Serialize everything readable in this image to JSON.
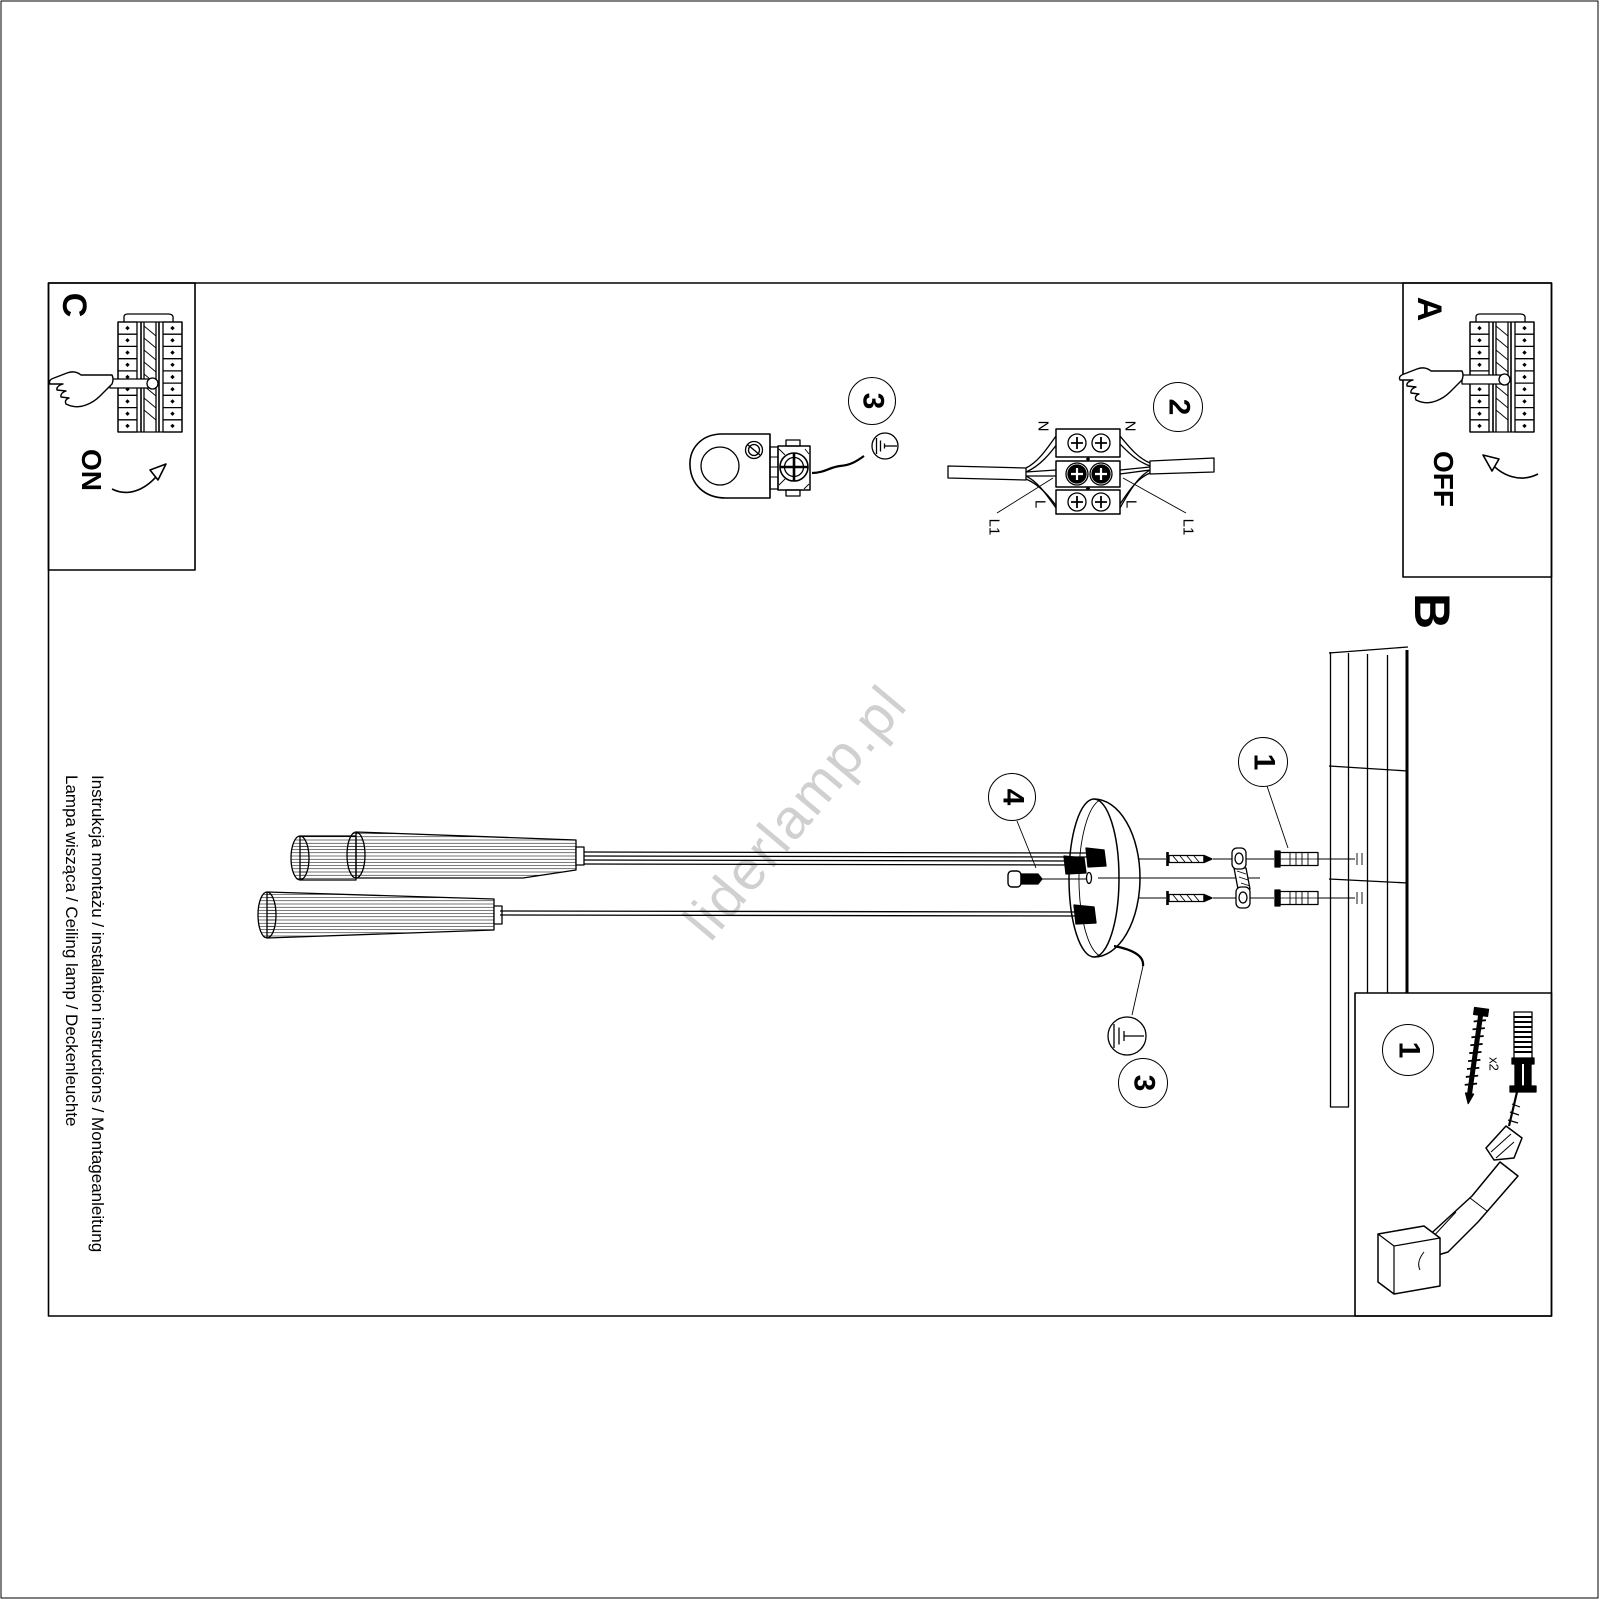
{
  "document": {
    "watermark": "liderlamp.pl",
    "side_caption": {
      "line1": "Instrukcja montażu / installation instructions / Montageanleitung",
      "line2": "Lampa wisząca / Ceiling lamp / Deckenleuchte"
    }
  },
  "sections": {
    "a": {
      "label": "A",
      "switch_state": "OFF"
    },
    "b": {
      "label": "B"
    },
    "c": {
      "label": "C",
      "switch_state": "ON"
    }
  },
  "badges": {
    "hook": "3",
    "wiring": "2",
    "wall_plug": "1",
    "canopy_screw": "4",
    "ground": "3",
    "parts": "1"
  },
  "wiring": {
    "left": {
      "n": "N",
      "l": "L",
      "l1": "L1"
    },
    "right": {
      "n": "N",
      "l": "L",
      "l1": "L1"
    }
  },
  "parts_box": {
    "screw_quantity": "x2"
  },
  "colors": {
    "line": "#000000",
    "watermark": "#d0d0d0",
    "background": "#ffffff"
  }
}
